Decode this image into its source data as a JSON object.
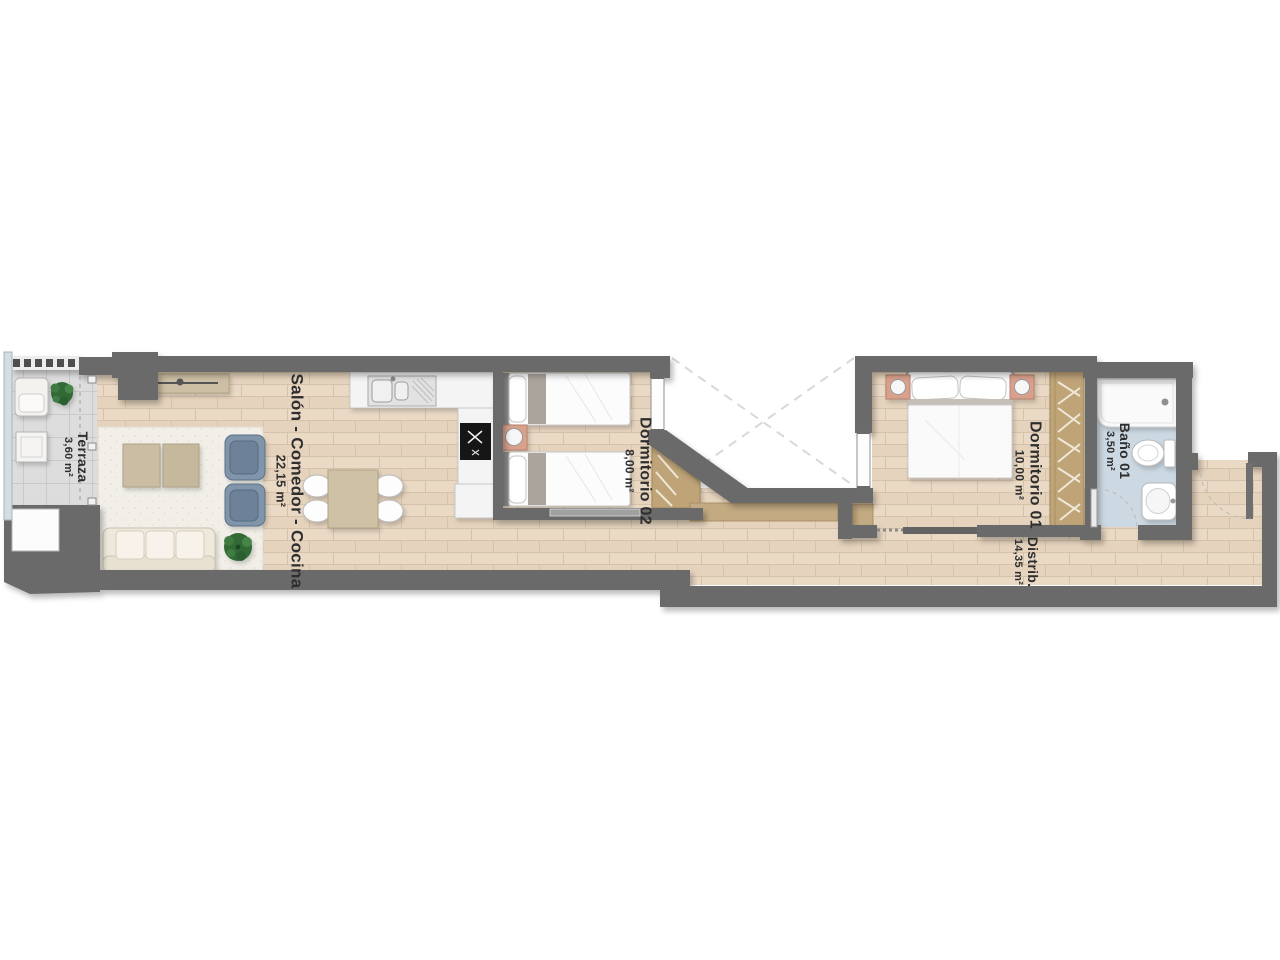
{
  "title": "Apartment floor plan",
  "rooms": {
    "terraza": {
      "name": "Terraza",
      "area": "3,60 m²"
    },
    "salon": {
      "name": "Salón - Comedor - Cocina",
      "area": "22,15 m²"
    },
    "dormitorio02": {
      "name": "Dormitorio 02",
      "area": "8,00 m²"
    },
    "dormitorio01": {
      "name": "Dormitorio 01",
      "area": "10,00 m²"
    },
    "bano01": {
      "name": "Baño 01",
      "area": "3,50 m²"
    },
    "distribuidor": {
      "name": "Distrib.",
      "area": "14,35 m²"
    }
  },
  "colors": {
    "wall": "#6a6a6a",
    "wall_dark": "#4f4f4f",
    "wood": "#e9d9c5",
    "wood_line": "#d6c2a8",
    "terrace_tile": "#dddddd",
    "tile_line": "#c9c9c9",
    "rug": "#f1efe8",
    "bath_floor": "#ccd9e3",
    "wardrobe": "#bfa478",
    "tan_strip": "#c3aa82",
    "nightstand": "#d9a18c",
    "armchair": "#8094aa",
    "armchair_dark": "#6d8299",
    "sofa": "#efe9dc",
    "table_wood": "#cfc1a6",
    "plant": "#336b36",
    "fixture_fill": "#f6f6f6",
    "fixture_stroke": "#b9b9b9",
    "glass": "#d2dde4",
    "label_text": "#2e2e2e"
  }
}
